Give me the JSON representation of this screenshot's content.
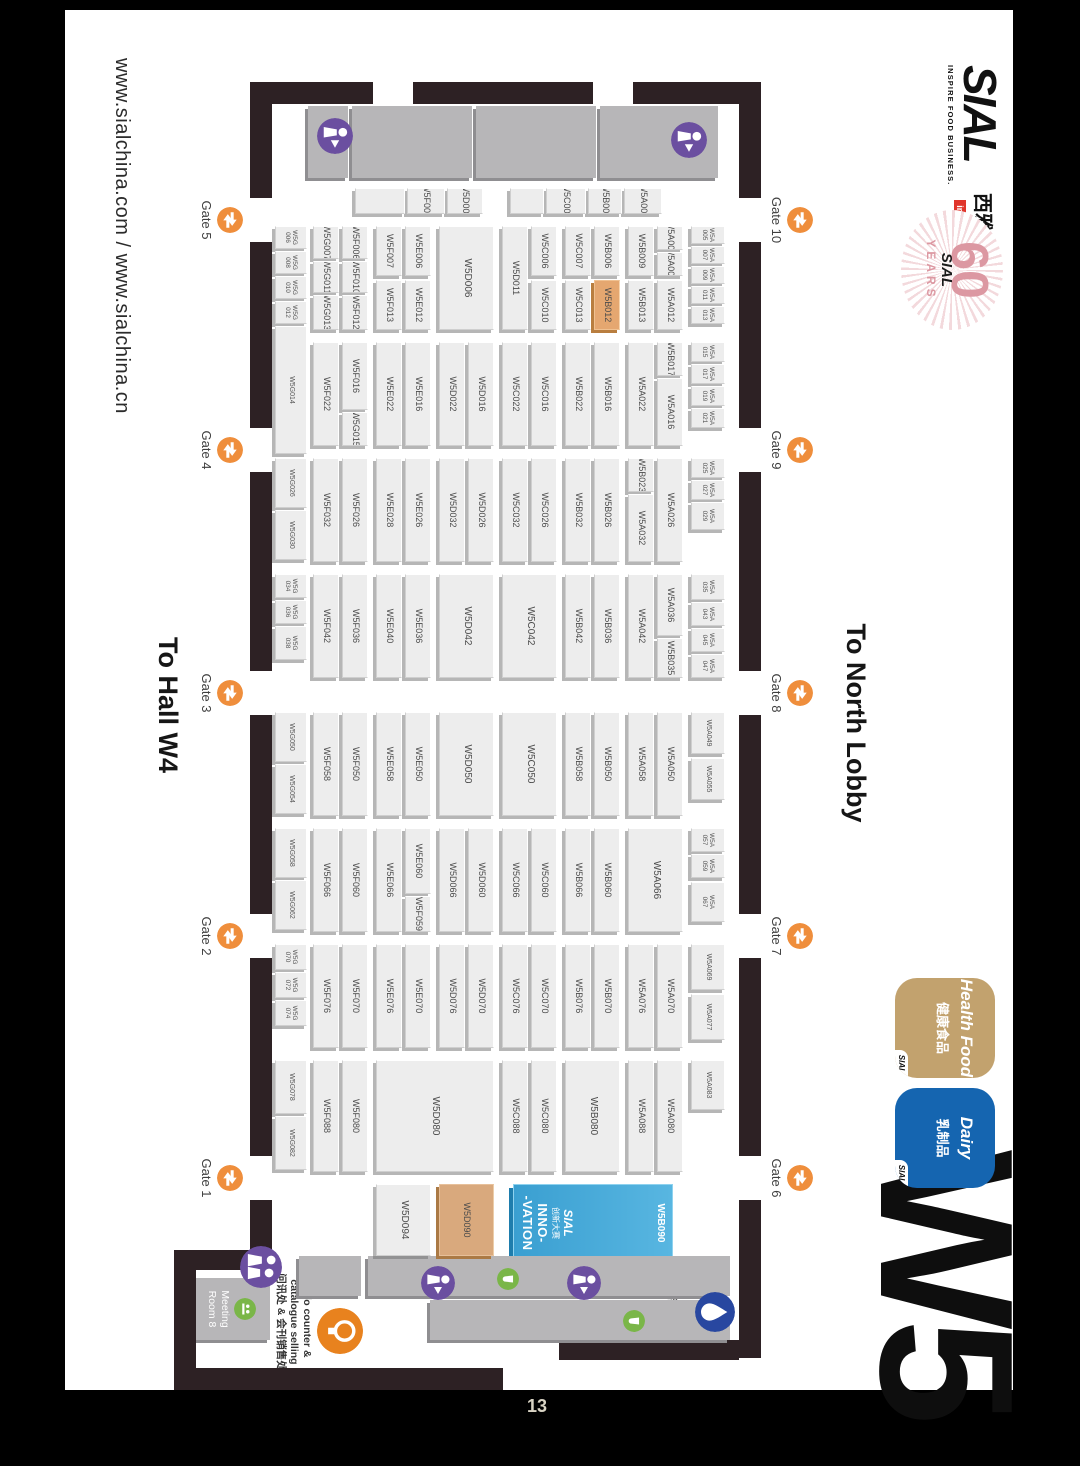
{
  "frame": {
    "page_number": "13"
  },
  "header": {
    "urls": "www.sialchina.com / www.sialchina.cn",
    "to_hall": "To Hall W4",
    "to_lobby": "To North Lobby",
    "hall": "W5"
  },
  "logo": {
    "sial": "SIAL",
    "tagline": "INSPIRE FOOD BUSINESS.",
    "cn": "西雅展",
    "in_china": "in China"
  },
  "anniversary": {
    "num": "60",
    "sial": "SIAL",
    "years": "YEARS"
  },
  "badges": [
    {
      "en": "Health Food",
      "cn": "健康食品",
      "sial": "SIAL",
      "bg": "#c2a26e"
    },
    {
      "en": "Dairy",
      "cn": "乳制品",
      "sial": "SIAL",
      "bg": "#1565b0"
    }
  ],
  "innovation": {
    "id": "W5B090",
    "sial": "SIAL",
    "cn": "创新大赛",
    "l1": "INNO-",
    "l2": "-VATION"
  },
  "facilities": {
    "meeting": "Meeting Room 8",
    "info1": "Info counter &",
    "info2": "catalogue selling",
    "info_cn": "问讯处 & 会刊销售处",
    "wash": "Washing area",
    "wash_cn": "清洗区",
    "snack": "Snack Bar"
  },
  "colors": {
    "gate_icon": "#ef8e3c",
    "person_icon": "#6b4fa0",
    "info_icon": "#e8821e",
    "wash_icon": "#2847a0",
    "snack_icon": "#7ab648",
    "wall": "#2d2124",
    "highlight_booth": "#e5a770",
    "tan_booth": "#d9a97d",
    "innovation_blue": "#45aad8"
  },
  "gates": {
    "top": [
      {
        "label": "Gate 10",
        "cx": 210
      },
      {
        "label": "Gate 9",
        "cx": 440
      },
      {
        "label": "Gate 8",
        "cx": 683
      },
      {
        "label": "Gate 7",
        "cx": 926
      },
      {
        "label": "Gate 6",
        "cx": 1168
      }
    ],
    "bottom": [
      {
        "label": "Gate 5",
        "cx": 210
      },
      {
        "label": "Gate 4",
        "cx": 440
      },
      {
        "label": "Gate 3",
        "cx": 683
      },
      {
        "label": "Gate 2",
        "cx": 926
      },
      {
        "label": "Gate 1",
        "cx": 1168
      }
    ]
  },
  "walls": [
    [
      72,
      252,
      116,
      22
    ],
    [
      232,
      252,
      186,
      22
    ],
    [
      462,
      252,
      199,
      22
    ],
    [
      705,
      252,
      199,
      22
    ],
    [
      948,
      252,
      198,
      22
    ],
    [
      1190,
      252,
      158,
      22
    ],
    [
      72,
      252,
      22,
      128
    ],
    [
      72,
      420,
      22,
      180
    ],
    [
      72,
      640,
      22,
      123
    ],
    [
      72,
      741,
      116,
      22
    ],
    [
      232,
      741,
      186,
      22
    ],
    [
      462,
      741,
      199,
      22
    ],
    [
      705,
      741,
      199,
      22
    ],
    [
      948,
      741,
      198,
      22
    ],
    [
      1190,
      741,
      50,
      22
    ],
    [
      1240,
      741,
      20,
      98
    ],
    [
      1240,
      817,
      140,
      22
    ],
    [
      1358,
      510,
      22,
      329
    ],
    [
      1330,
      274,
      20,
      180
    ]
  ],
  "slabs": [
    [
      96,
      295,
      72,
      118
    ],
    [
      96,
      417,
      72,
      120
    ],
    [
      96,
      541,
      72,
      120
    ],
    [
      96,
      665,
      72,
      40
    ],
    [
      1246,
      283,
      40,
      362
    ],
    [
      1290,
      283,
      40,
      300
    ],
    [
      1246,
      652,
      40,
      62
    ]
  ],
  "booths": [
    [
      "W5A001",
      178,
      351,
      26,
      38
    ],
    [
      "W5B001",
      178,
      391,
      26,
      34
    ],
    [
      "W5C001",
      178,
      427,
      26,
      40
    ],
    [
      "",
      178,
      469,
      26,
      34
    ],
    [
      "W5D002",
      178,
      530,
      26,
      36
    ],
    [
      "W5F003",
      178,
      568,
      26,
      38
    ],
    [
      "",
      178,
      608,
      26,
      50
    ],
    [
      "W5A005",
      216,
      288,
      18,
      34,
      "s"
    ],
    [
      "W5A007",
      236,
      288,
      18,
      34,
      "s"
    ],
    [
      "W5A009",
      256,
      288,
      18,
      34,
      "s"
    ],
    [
      "W5A011",
      276,
      288,
      18,
      34,
      "s"
    ],
    [
      "W5A013",
      296,
      288,
      18,
      34,
      "s"
    ],
    [
      "W5A006",
      216,
      330,
      24,
      26
    ],
    [
      "W5A008",
      242,
      330,
      24,
      26
    ],
    [
      "W5A012",
      270,
      330,
      50,
      26
    ],
    [
      "W5B009",
      216,
      359,
      50,
      26
    ],
    [
      "W5B013",
      270,
      359,
      50,
      26
    ],
    [
      "W5B006",
      216,
      393,
      50,
      26
    ],
    [
      "W5B012",
      270,
      393,
      50,
      26,
      "hl"
    ],
    [
      "W5C007",
      216,
      422,
      50,
      26
    ],
    [
      "W5C013",
      270,
      422,
      50,
      26
    ],
    [
      "W5C006",
      216,
      456,
      50,
      26
    ],
    [
      "W5C010",
      270,
      456,
      50,
      26
    ],
    [
      "W5D011",
      216,
      485,
      104,
      26
    ],
    [
      "W5D006",
      216,
      519,
      104,
      55,
      "b"
    ],
    [
      "W5E006",
      216,
      582,
      50,
      26
    ],
    [
      "W5E012",
      270,
      582,
      50,
      26
    ],
    [
      "W5F007",
      216,
      611,
      50,
      26
    ],
    [
      "W5F013",
      270,
      611,
      50,
      26
    ],
    [
      "W5F006",
      216,
      645,
      33,
      26
    ],
    [
      "W5F010",
      251,
      645,
      32,
      26
    ],
    [
      "W5F012",
      285,
      645,
      35,
      26
    ],
    [
      "W5G007",
      216,
      674,
      33,
      26
    ],
    [
      "W5G011",
      251,
      674,
      32,
      26
    ],
    [
      "W5G013",
      285,
      674,
      35,
      26
    ],
    [
      "W5G006",
      216,
      706,
      23,
      32,
      "s"
    ],
    [
      "W5G008",
      241,
      706,
      23,
      32,
      "s"
    ],
    [
      "W5G010",
      266,
      706,
      23,
      32,
      "s"
    ],
    [
      "W5G012",
      291,
      706,
      23,
      32,
      "s"
    ],
    [
      "W5A015",
      332,
      288,
      20,
      34,
      "s"
    ],
    [
      "W5A017",
      354,
      288,
      20,
      34,
      "s"
    ],
    [
      "W5A019",
      376,
      288,
      20,
      34,
      "s"
    ],
    [
      "W5A021",
      398,
      288,
      20,
      34,
      "s"
    ],
    [
      "W5B017",
      332,
      330,
      34,
      26
    ],
    [
      "W5A016",
      368,
      330,
      68,
      26
    ],
    [
      "W5A022",
      332,
      359,
      104,
      26
    ],
    [
      "W5B016",
      332,
      393,
      104,
      26
    ],
    [
      "W5B022",
      332,
      422,
      104,
      26
    ],
    [
      "W5C016",
      332,
      456,
      104,
      26
    ],
    [
      "W5C022",
      332,
      485,
      104,
      26
    ],
    [
      "W5D016",
      332,
      519,
      104,
      26
    ],
    [
      "W5D022",
      332,
      548,
      104,
      26
    ],
    [
      "W5E016",
      332,
      582,
      104,
      26
    ],
    [
      "W5E022",
      332,
      611,
      104,
      26
    ],
    [
      "W5F016",
      332,
      645,
      68,
      26
    ],
    [
      "W5G015",
      402,
      645,
      34,
      26
    ],
    [
      "W5F022",
      332,
      674,
      104,
      26
    ],
    [
      "W5G014",
      316,
      706,
      128,
      32,
      "s"
    ],
    [
      "W5A025",
      448,
      288,
      20,
      34,
      "s"
    ],
    [
      "W5A027",
      470,
      288,
      20,
      34,
      "s"
    ],
    [
      "W5A029",
      492,
      288,
      28,
      34,
      "s"
    ],
    [
      "W5A026",
      448,
      330,
      104,
      26
    ],
    [
      "W5B023",
      448,
      359,
      34,
      26
    ],
    [
      "W5A032",
      484,
      359,
      68,
      26
    ],
    [
      "W5B026",
      448,
      393,
      104,
      26
    ],
    [
      "W5B032",
      448,
      422,
      104,
      26
    ],
    [
      "W5C026",
      448,
      456,
      104,
      26
    ],
    [
      "W5C032",
      448,
      485,
      104,
      26
    ],
    [
      "W5D026",
      448,
      519,
      104,
      26
    ],
    [
      "W5D032",
      448,
      548,
      104,
      26
    ],
    [
      "W5E026",
      448,
      582,
      104,
      26
    ],
    [
      "W5E028",
      448,
      611,
      104,
      26
    ],
    [
      "W5F026",
      448,
      645,
      104,
      26
    ],
    [
      "W5F032",
      448,
      674,
      104,
      26
    ],
    [
      "W5G026",
      448,
      706,
      50,
      32,
      "s"
    ],
    [
      "W5G030",
      500,
      706,
      50,
      32,
      "s"
    ],
    [
      "W5A035",
      564,
      288,
      26,
      34,
      "s"
    ],
    [
      "W5A043",
      592,
      288,
      24,
      34,
      "s"
    ],
    [
      "W5A045",
      618,
      288,
      24,
      34,
      "s"
    ],
    [
      "W5A047",
      644,
      288,
      24,
      34,
      "s"
    ],
    [
      "W5A036",
      564,
      330,
      62,
      26
    ],
    [
      "W5B035",
      628,
      330,
      40,
      26
    ],
    [
      "W5A042",
      564,
      359,
      104,
      26
    ],
    [
      "W5B036",
      564,
      393,
      104,
      26
    ],
    [
      "W5B042",
      564,
      422,
      104,
      26
    ],
    [
      "W5C042",
      564,
      456,
      104,
      55,
      "b"
    ],
    [
      "W5D042",
      564,
      519,
      104,
      55,
      "b"
    ],
    [
      "W5E036",
      564,
      582,
      104,
      26
    ],
    [
      "W5E040",
      564,
      611,
      104,
      26
    ],
    [
      "W5F036",
      564,
      645,
      104,
      26
    ],
    [
      "W5F042",
      564,
      674,
      104,
      26
    ],
    [
      "W5G034",
      564,
      706,
      24,
      32,
      "s"
    ],
    [
      "W5G036",
      590,
      706,
      24,
      32,
      "s"
    ],
    [
      "W5G038",
      616,
      706,
      34,
      32,
      "s"
    ],
    [
      "W5A049",
      702,
      288,
      42,
      34,
      "s"
    ],
    [
      "W5A055",
      748,
      288,
      42,
      34,
      "s"
    ],
    [
      "W5A050",
      702,
      330,
      104,
      26
    ],
    [
      "W5A058",
      702,
      359,
      104,
      26
    ],
    [
      "W5B050",
      702,
      393,
      104,
      26
    ],
    [
      "W5B058",
      702,
      422,
      104,
      26
    ],
    [
      "W5C050",
      702,
      456,
      104,
      55,
      "b"
    ],
    [
      "W5D050",
      702,
      519,
      104,
      55,
      "b"
    ],
    [
      "W5E050",
      702,
      582,
      104,
      26
    ],
    [
      "W5E058",
      702,
      611,
      104,
      26
    ],
    [
      "W5F050",
      702,
      645,
      104,
      26
    ],
    [
      "W5F058",
      702,
      674,
      104,
      26
    ],
    [
      "W5G050",
      702,
      706,
      50,
      32,
      "s"
    ],
    [
      "W5G054",
      754,
      706,
      50,
      32,
      "s"
    ],
    [
      "W5A057",
      818,
      288,
      24,
      34,
      "s"
    ],
    [
      "W5A059",
      844,
      288,
      24,
      34,
      "s"
    ],
    [
      "W5A067",
      872,
      288,
      40,
      34,
      "s"
    ],
    [
      "W5A066",
      818,
      330,
      104,
      55,
      "b"
    ],
    [
      "W5B060",
      818,
      393,
      104,
      26
    ],
    [
      "W5B066",
      818,
      422,
      104,
      26
    ],
    [
      "W5C060",
      818,
      456,
      104,
      26
    ],
    [
      "W5C066",
      818,
      485,
      104,
      26
    ],
    [
      "W5D060",
      818,
      519,
      104,
      26
    ],
    [
      "W5D066",
      818,
      548,
      104,
      26
    ],
    [
      "W5E060",
      818,
      582,
      66,
      26
    ],
    [
      "W5F059",
      886,
      582,
      36,
      26
    ],
    [
      "W5E066",
      818,
      611,
      104,
      26
    ],
    [
      "W5F060",
      818,
      645,
      104,
      26
    ],
    [
      "W5F066",
      818,
      674,
      104,
      26
    ],
    [
      "W5G058",
      818,
      706,
      50,
      32,
      "s"
    ],
    [
      "W5G062",
      870,
      706,
      50,
      32,
      "s"
    ],
    [
      "W5A069",
      934,
      288,
      46,
      34,
      "s"
    ],
    [
      "W5A077",
      984,
      288,
      46,
      34,
      "s"
    ],
    [
      "W5A070",
      934,
      330,
      104,
      26
    ],
    [
      "W5A076",
      934,
      359,
      104,
      26
    ],
    [
      "W5B070",
      934,
      393,
      104,
      26
    ],
    [
      "W5B076",
      934,
      422,
      104,
      26
    ],
    [
      "W5C070",
      934,
      456,
      104,
      26
    ],
    [
      "W5C076",
      934,
      485,
      104,
      26
    ],
    [
      "W5D070",
      934,
      519,
      104,
      26
    ],
    [
      "W5D076",
      934,
      548,
      104,
      26
    ],
    [
      "W5E070",
      934,
      582,
      104,
      26
    ],
    [
      "W5E076",
      934,
      611,
      104,
      26
    ],
    [
      "W5F070",
      934,
      645,
      104,
      26
    ],
    [
      "W5F076",
      934,
      674,
      104,
      26
    ],
    [
      "W5G070",
      934,
      706,
      26,
      32,
      "s"
    ],
    [
      "W5G072",
      962,
      706,
      26,
      32,
      "s"
    ],
    [
      "W5G074",
      990,
      706,
      26,
      32,
      "s"
    ],
    [
      "W5A083",
      1050,
      288,
      50,
      34,
      "s"
    ],
    [
      "W5A080",
      1050,
      330,
      112,
      26
    ],
    [
      "W5A088",
      1050,
      359,
      112,
      26
    ],
    [
      "W5B080",
      1050,
      393,
      112,
      55,
      "b"
    ],
    [
      "W5C080",
      1050,
      456,
      112,
      26
    ],
    [
      "W5C088",
      1050,
      485,
      112,
      26
    ],
    [
      "W5D080",
      1050,
      519,
      112,
      118,
      "b"
    ],
    [
      "W5F080",
      1050,
      645,
      112,
      26
    ],
    [
      "W5F088",
      1050,
      674,
      112,
      26
    ],
    [
      "W5G078",
      1050,
      706,
      54,
      32,
      "s"
    ],
    [
      "W5G082",
      1106,
      706,
      54,
      32,
      "s"
    ],
    [
      "W5D090",
      1174,
      519,
      72,
      55,
      "tan"
    ],
    [
      "W5D094",
      1174,
      582,
      72,
      55,
      "b"
    ]
  ],
  "icons": [
    {
      "name": "restroom-person-icon",
      "type": "person",
      "x": 112,
      "y": 306,
      "d": 36
    },
    {
      "name": "restroom-person-icon",
      "type": "person",
      "x": 108,
      "y": 660,
      "d": 36
    },
    {
      "name": "restroom-person-icon",
      "type": "person",
      "x": 1256,
      "y": 412,
      "d": 34
    },
    {
      "name": "restroom-person-icon",
      "type": "person",
      "x": 1256,
      "y": 558,
      "d": 34
    },
    {
      "name": "restroom-people-icon",
      "type": "person2",
      "x": 1236,
      "y": 731,
      "d": 42
    },
    {
      "name": "info-counter-bulb-icon",
      "type": "bulb",
      "x": 1298,
      "y": 650,
      "d": 46
    },
    {
      "name": "washing-area-drop-icon",
      "type": "drop",
      "x": 1282,
      "y": 278,
      "d": 40
    },
    {
      "name": "snack-bar-icon",
      "type": "snack",
      "x": 1258,
      "y": 494,
      "d": 22
    },
    {
      "name": "snack-bar-icon",
      "type": "snack",
      "x": 1300,
      "y": 368,
      "d": 22
    },
    {
      "name": "meeting-room-icon",
      "type": "meet",
      "x": 0,
      "y": 0,
      "d": 22
    }
  ]
}
